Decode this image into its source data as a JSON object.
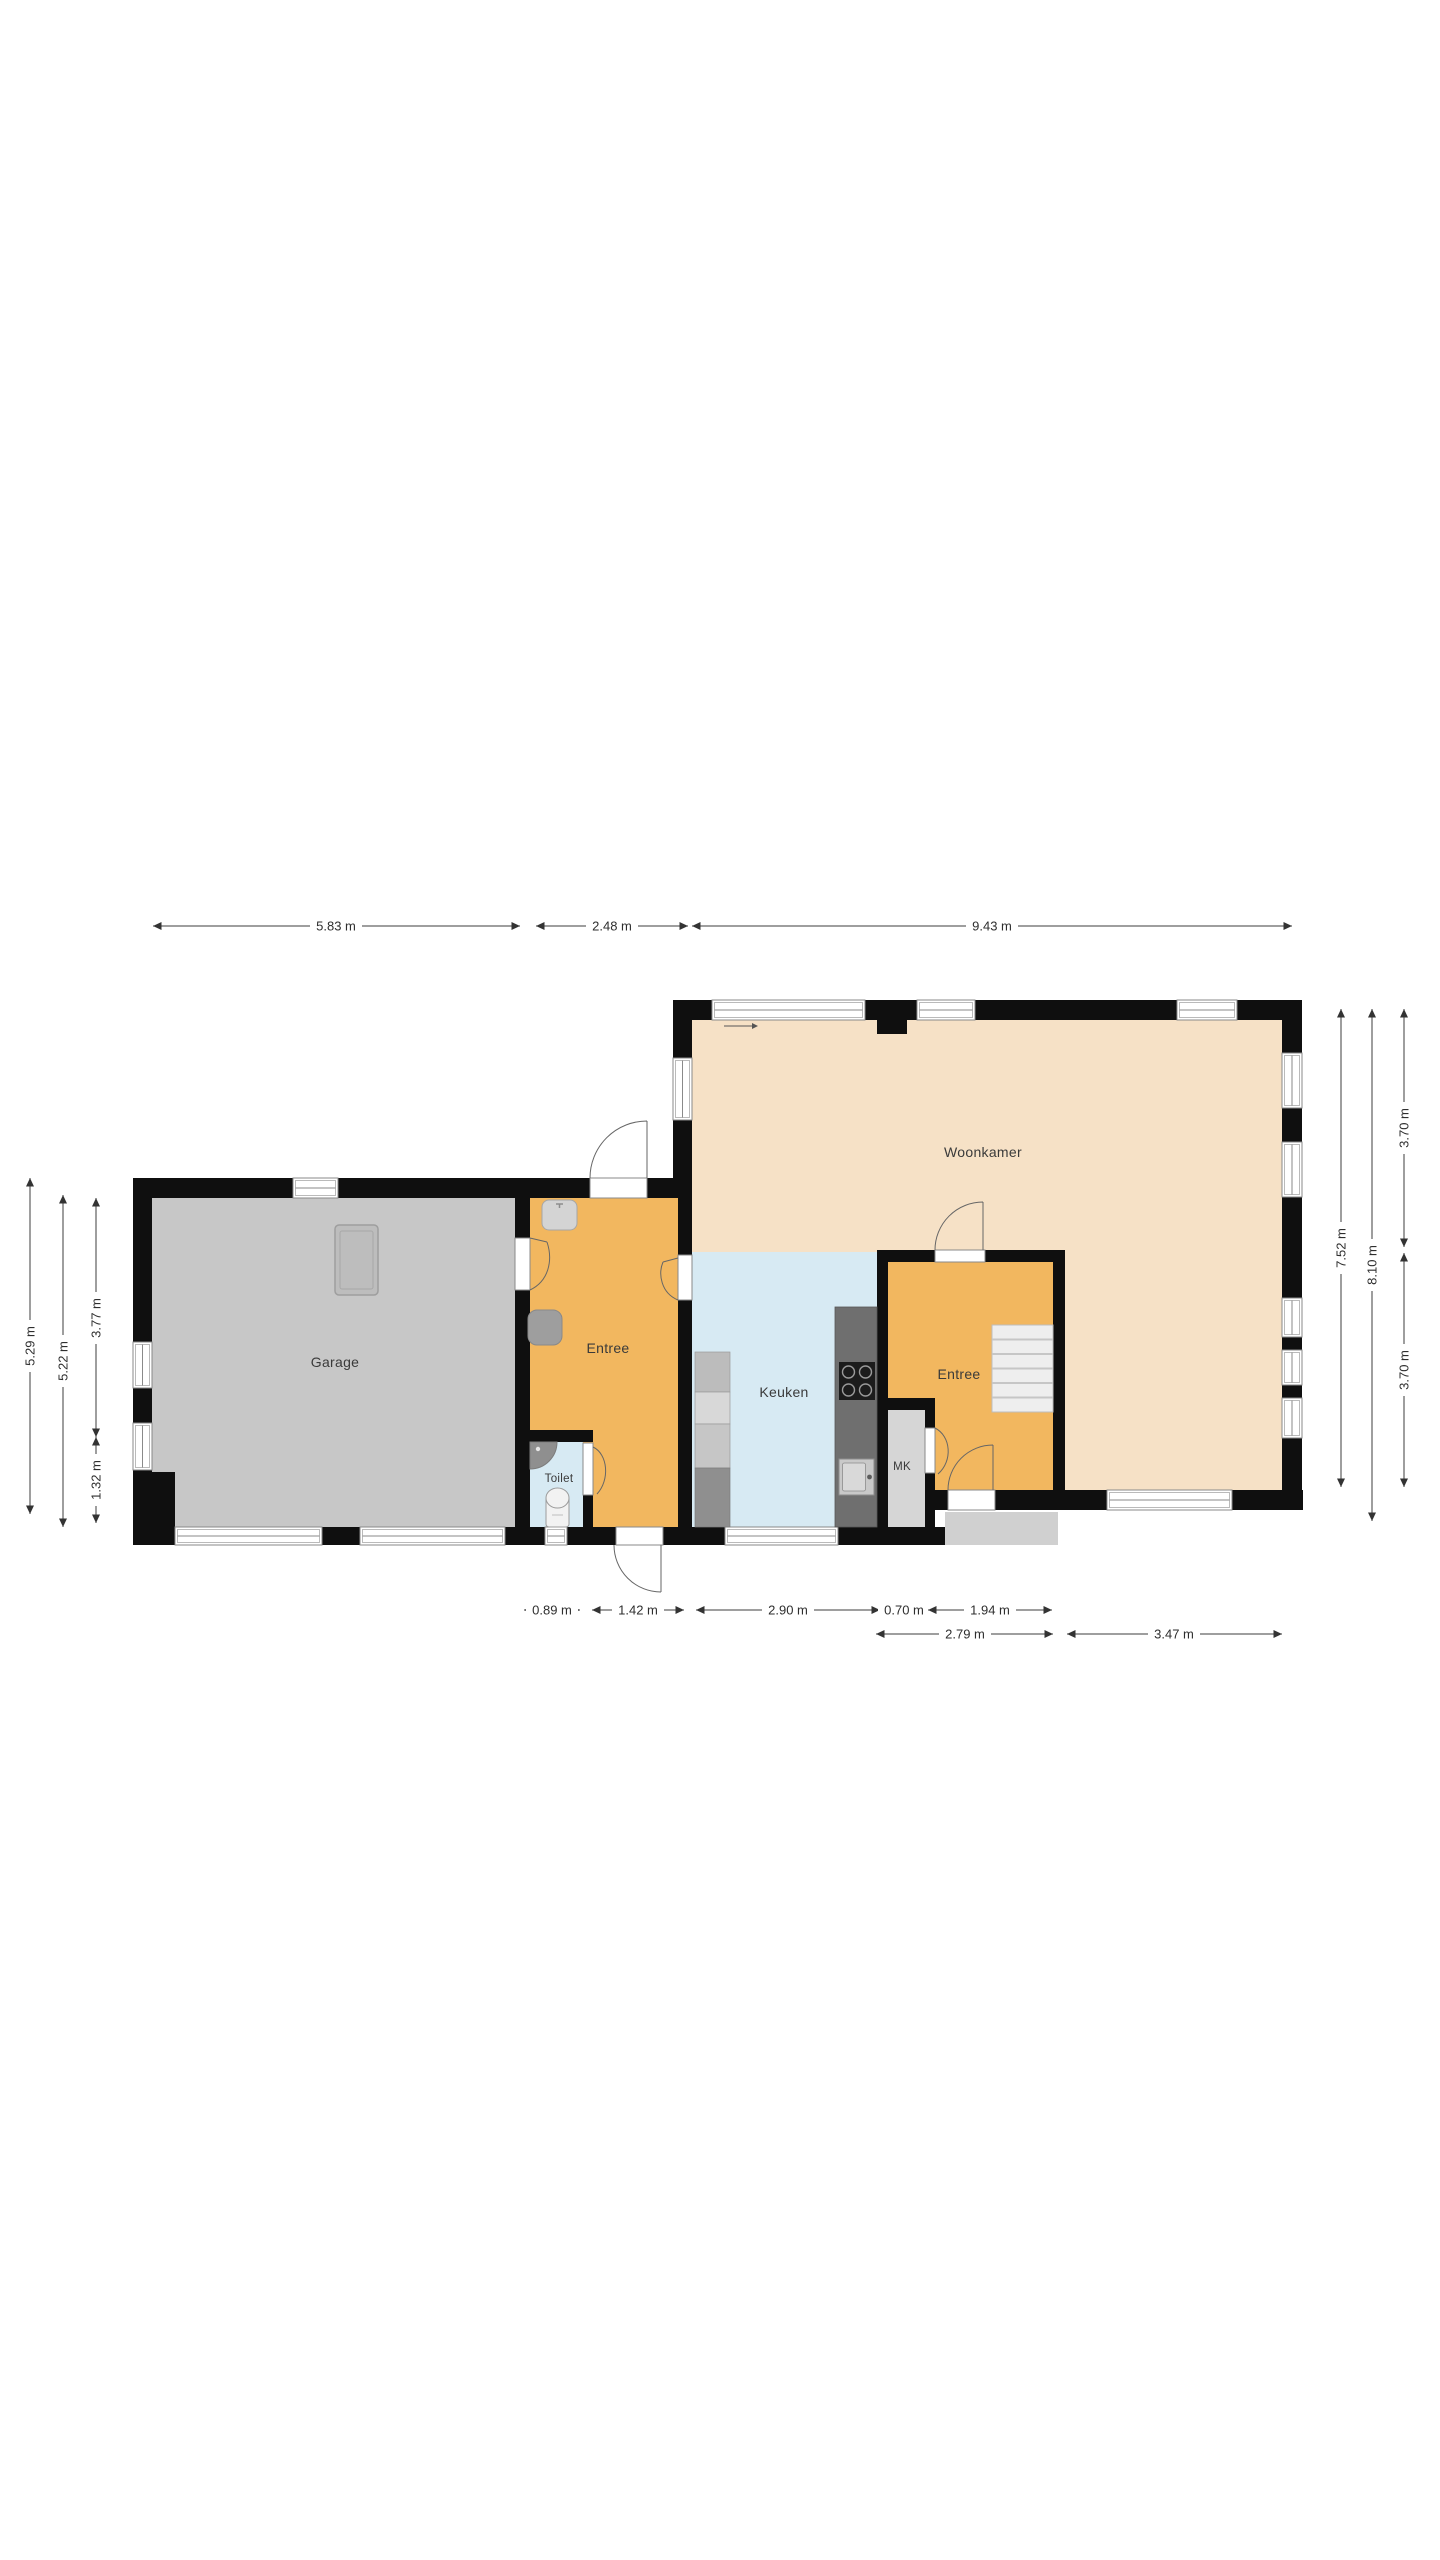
{
  "rooms": {
    "woonkamer": {
      "label": "Woonkamer"
    },
    "garage": {
      "label": "Garage"
    },
    "entree_main": {
      "label": "Entree"
    },
    "entree_rear": {
      "label": "Entree"
    },
    "keuken": {
      "label": "Keuken"
    },
    "toilet": {
      "label": "Toilet"
    },
    "mk": {
      "label": "MK"
    }
  },
  "dimensions": {
    "top": [
      "5.83 m",
      "2.48 m",
      "9.43 m"
    ],
    "bottom_row1": [
      "0.89 m",
      "1.42 m",
      "2.90 m",
      "0.70 m",
      "1.94 m"
    ],
    "bottom_row2": [
      "2.79 m",
      "3.47 m"
    ],
    "left": [
      "5.29 m",
      "5.22 m",
      "3.77 m",
      "1.32 m"
    ],
    "right": [
      "7.52 m",
      "8.10 m",
      "3.70 m",
      "3.70 m"
    ]
  },
  "colors": {
    "wall": "#0f0f0f",
    "garage_floor": "#c7c7c7",
    "entree_floor": "#f2b75f",
    "keuken_floor": "#d7eaf3",
    "toilet_floor": "#d7eaf3",
    "woonkamer_floor": "#f6e1c6",
    "mk_floor": "#d6d6d6",
    "porch": "#d0d0d0",
    "stairs": "#ededed",
    "counter_dark": "#6f6f6f",
    "dim_text": "#2e2e2e"
  }
}
